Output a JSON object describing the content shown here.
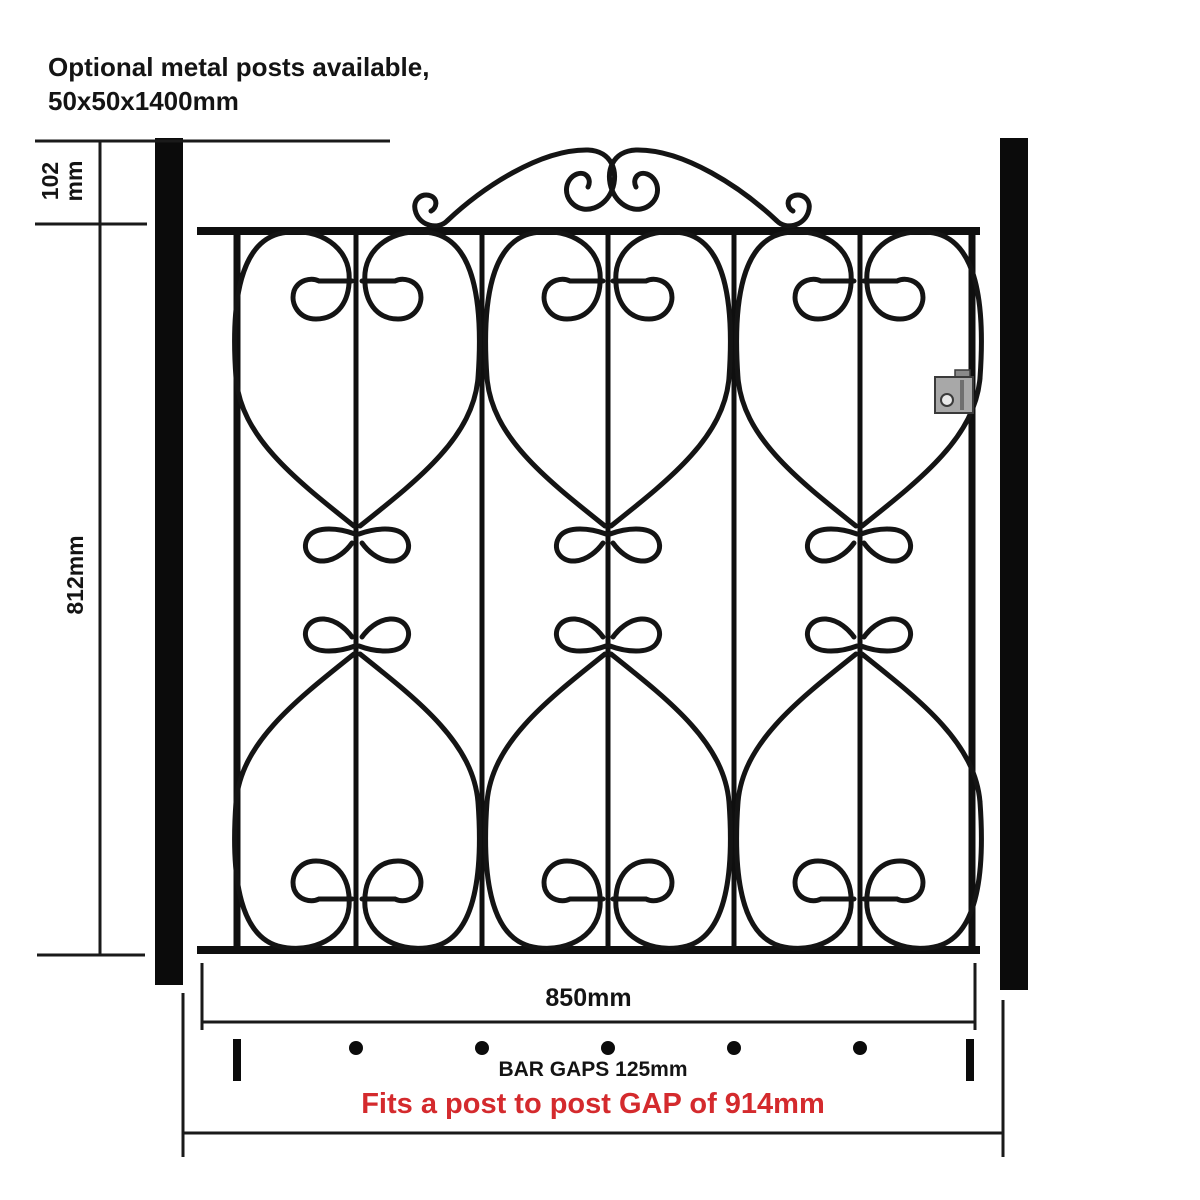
{
  "header": {
    "note_line1": "Optional metal posts available,",
    "note_line2": "50x50x1400mm"
  },
  "dimensions": {
    "scroll_height_value": "102",
    "scroll_height_unit": "mm",
    "gate_height": "812mm",
    "gate_width": "850mm",
    "bar_gaps_label": "BAR GAPS 125mm",
    "post_gap_label": "Fits a post to post GAP of 914mm"
  },
  "colors": {
    "metal_black": "#141414",
    "accent_red": "#d42a2d",
    "latch_gray": "#a8a8a8"
  }
}
